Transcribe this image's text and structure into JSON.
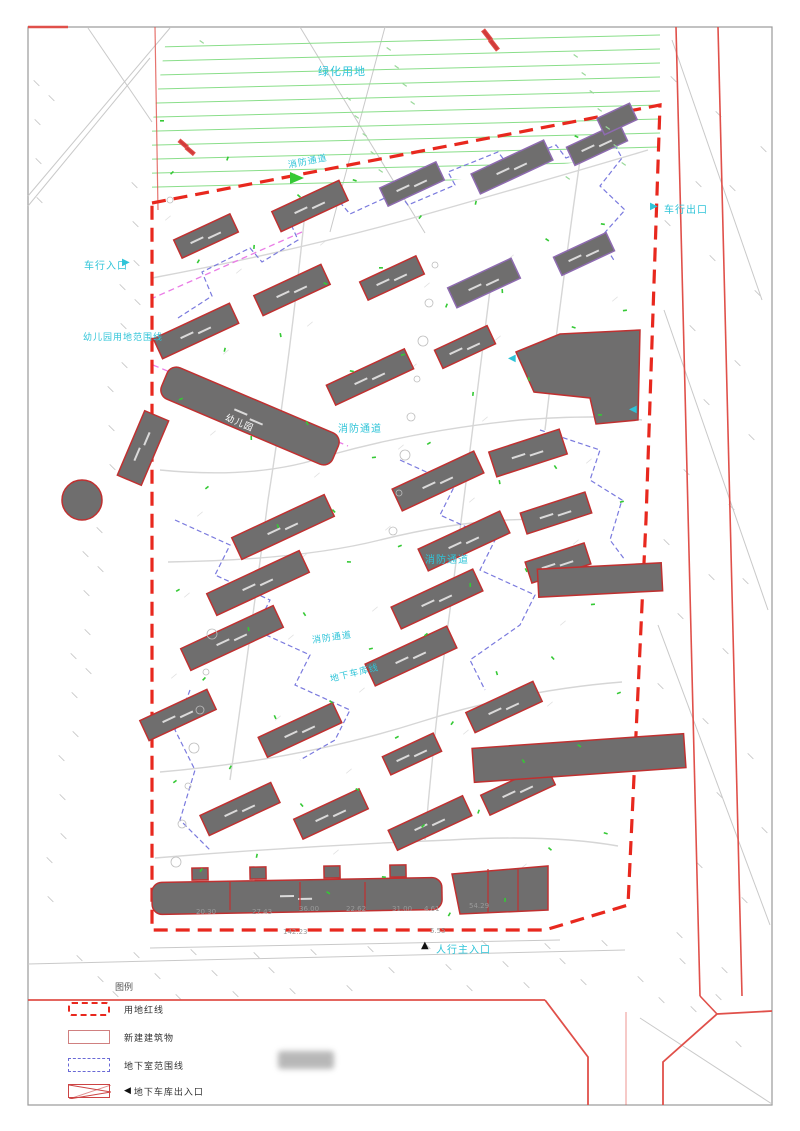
{
  "colors": {
    "boundary_red": "#e8281e",
    "road_red": "#e0504a",
    "building_fill": "#6f6e6e",
    "building_stroke_red": "#c03030",
    "building_stroke_purple": "#8e6bb0",
    "cyan_label": "#2fc4d8",
    "green_hatch": "#8ade8a",
    "green_mark": "#35c935",
    "blue_dashed": "#7a7ade",
    "magenta_dashed": "#ea7ce6",
    "frame_gray": "#9a9a9a"
  },
  "map": {
    "labels": [
      {
        "text": "绿化用地",
        "x": 318,
        "y": 68,
        "color": "#2fc4d8",
        "size": 11,
        "rot": 0
      },
      {
        "text": "消防通道",
        "x": 288,
        "y": 162,
        "color": "#2fc4d8",
        "size": 9,
        "rot": -11
      },
      {
        "text": "车行入口",
        "x": 84,
        "y": 262,
        "color": "#2fc4d8",
        "size": 10,
        "rot": 0
      },
      {
        "text": "车行出口",
        "x": 664,
        "y": 206,
        "color": "#2fc4d8",
        "size": 10,
        "rot": 0
      },
      {
        "text": "幼儿园用地范围线",
        "x": 83,
        "y": 334,
        "color": "#2fc4d8",
        "size": 9,
        "rot": 0
      },
      {
        "text": "消防通道",
        "x": 338,
        "y": 425,
        "color": "#2fc4d8",
        "size": 10,
        "rot": 0
      },
      {
        "text": "消防通道",
        "x": 425,
        "y": 556,
        "color": "#2fc4d8",
        "size": 10,
        "rot": 0
      },
      {
        "text": "消防通道",
        "x": 312,
        "y": 637,
        "color": "#2fc4d8",
        "size": 9,
        "rot": -8
      },
      {
        "text": "地下车库线",
        "x": 330,
        "y": 676,
        "color": "#2fc4d8",
        "size": 9,
        "rot": -14
      },
      {
        "text": "幼儿园",
        "x": 226,
        "y": 414,
        "color": "#ffffff",
        "size": 9,
        "rot": 23
      },
      {
        "text": "人行主入口",
        "x": 436,
        "y": 946,
        "color": "#2fc4d8",
        "size": 10,
        "rot": 0
      }
    ],
    "arrows": [
      {
        "name": "vehicle-entrance-arrow-icon",
        "glyph": "▶",
        "x": 122,
        "y": 263,
        "color": "#2fc4d8"
      },
      {
        "name": "vehicle-exit-arrow-icon",
        "glyph": "▶",
        "x": 650,
        "y": 207,
        "color": "#2fc4d8"
      },
      {
        "name": "garage-ramp-arrow-icon",
        "glyph": "◀",
        "x": 629,
        "y": 410,
        "color": "#2fc4d8"
      },
      {
        "name": "side-entrance-arrow-icon",
        "glyph": "◀",
        "x": 508,
        "y": 359,
        "color": "#2fc4d8"
      },
      {
        "name": "pedestrian-main-entrance-arrow-icon",
        "glyph": "▲",
        "x": 421,
        "y": 946,
        "color": "#111111"
      }
    ],
    "dimensions": [
      {
        "text": "20.30",
        "x": 196,
        "y": 912
      },
      {
        "text": "27.43",
        "x": 252,
        "y": 912
      },
      {
        "text": "36.00",
        "x": 299,
        "y": 909
      },
      {
        "text": "22.62",
        "x": 346,
        "y": 909
      },
      {
        "text": "31.00",
        "x": 392,
        "y": 909
      },
      {
        "text": "4.61",
        "x": 424,
        "y": 909
      },
      {
        "text": "54.29",
        "x": 469,
        "y": 906
      },
      {
        "text": "142.23",
        "x": 283,
        "y": 932
      },
      {
        "text": "5.55",
        "x": 430,
        "y": 931
      }
    ]
  },
  "legend": {
    "title": "图例",
    "garage_arrow": "◀",
    "items": [
      {
        "label": "用地红线"
      },
      {
        "label": "新建建筑物"
      },
      {
        "label": "地下室范围线"
      },
      {
        "label": "地下车库出入口"
      }
    ]
  }
}
